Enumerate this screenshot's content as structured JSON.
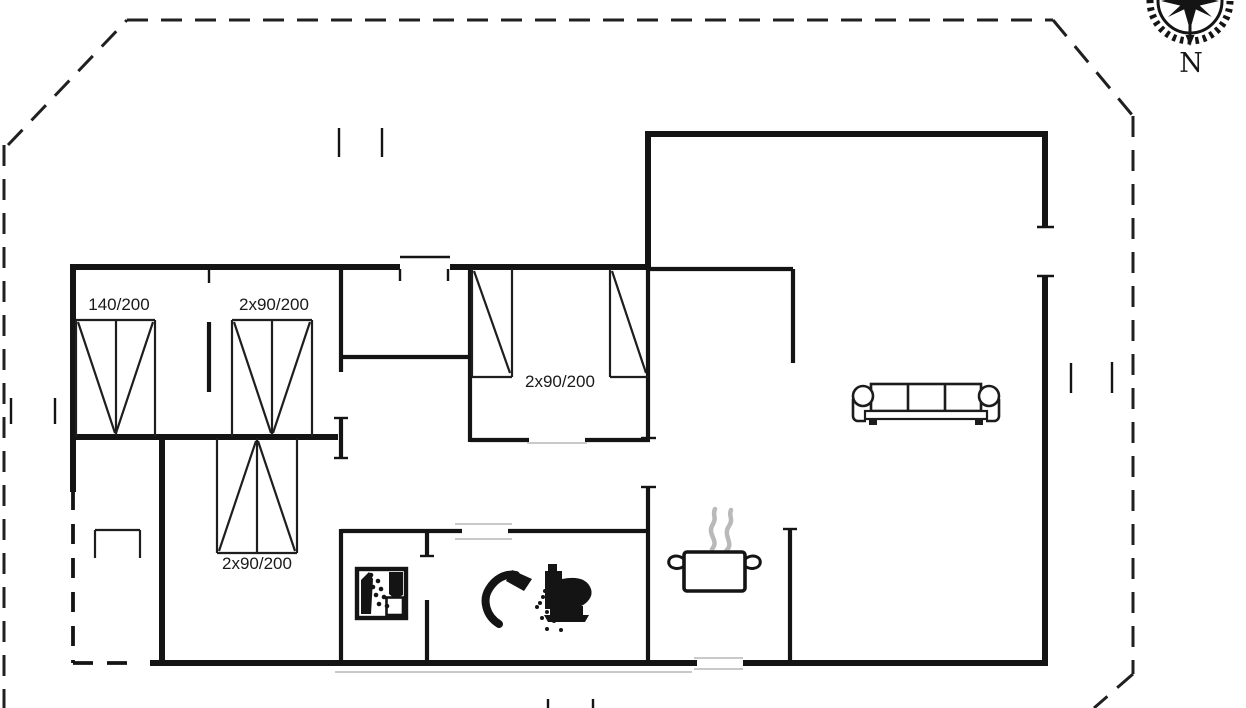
{
  "compass": {
    "label": "N"
  },
  "labels": [
    {
      "id": "bed-double-140",
      "text": "140/200",
      "x": 79,
      "y": 296,
      "w": 80
    },
    {
      "id": "bed-twin-top",
      "text": "2x90/200",
      "x": 226,
      "y": 296,
      "w": 96
    },
    {
      "id": "bed-twin-middle",
      "text": "2x90/200",
      "x": 512,
      "y": 373,
      "w": 96
    },
    {
      "id": "bed-twin-bottom",
      "text": "2x90/200",
      "x": 208,
      "y": 555,
      "w": 98
    }
  ],
  "icons": [
    {
      "name": "compass-rose-icon"
    },
    {
      "name": "washing-machine-icon"
    },
    {
      "name": "shower-icon"
    },
    {
      "name": "toilet-icon"
    },
    {
      "name": "cooking-pot-icon"
    },
    {
      "name": "sofa-symbol"
    }
  ],
  "floorplan": {
    "background": "#ffffff",
    "ink": "#141414",
    "faint": "#c9c9c9",
    "steam": "#b9b9b9",
    "layers": [
      {
        "cls": "wall-thick",
        "width": 6,
        "color": "#141414",
        "dash": null,
        "segs": [
          [
            70,
            267,
            400,
            267
          ],
          [
            450,
            267,
            651,
            267
          ],
          [
            648,
            131,
            648,
            269
          ],
          [
            645,
            134,
            1048,
            134
          ],
          [
            1045,
            131,
            1045,
            227
          ],
          [
            1045,
            276,
            1045,
            666
          ],
          [
            743,
            663,
            1048,
            663
          ],
          [
            150,
            663,
            697,
            663
          ],
          [
            73,
            264,
            73,
            492
          ],
          [
            71,
            437,
            338,
            437
          ],
          [
            162,
            435,
            162,
            665
          ]
        ]
      },
      {
        "cls": "wall-medium",
        "width": 4.2,
        "color": "#141414",
        "dash": null,
        "segs": [
          [
            648,
            269,
            793,
            269
          ],
          [
            793,
            269,
            793,
            363
          ],
          [
            209,
            322,
            209,
            392
          ],
          [
            341,
            267,
            341,
            372
          ],
          [
            341,
            357,
            470,
            357
          ],
          [
            470,
            267,
            470,
            442
          ],
          [
            341,
            418,
            341,
            458
          ],
          [
            470,
            440,
            529,
            440
          ],
          [
            585,
            440,
            650,
            440
          ],
          [
            648,
            269,
            648,
            438
          ],
          [
            648,
            487,
            648,
            665
          ],
          [
            341,
            531,
            462,
            531
          ],
          [
            508,
            531,
            650,
            531
          ],
          [
            341,
            529,
            341,
            665
          ],
          [
            427,
            531,
            427,
            556
          ],
          [
            427,
            600,
            427,
            665
          ],
          [
            790,
            529,
            790,
            665
          ]
        ]
      },
      {
        "cls": "tick-thin",
        "width": 2.4,
        "color": "#141414",
        "dash": null,
        "segs": [
          [
            209,
            270,
            209,
            283
          ],
          [
            400,
            269,
            400,
            281
          ],
          [
            448,
            269,
            448,
            281
          ],
          [
            339,
            128,
            339,
            157
          ],
          [
            382,
            128,
            382,
            157
          ],
          [
            11,
            398,
            11,
            424
          ],
          [
            55,
            398,
            55,
            424
          ],
          [
            1071,
            363,
            1071,
            393
          ],
          [
            1112,
            362,
            1112,
            393
          ],
          [
            548,
            699,
            548,
            708
          ],
          [
            593,
            699,
            593,
            708
          ],
          [
            1037,
            227,
            1054,
            227
          ],
          [
            1037,
            276,
            1054,
            276
          ],
          [
            641,
            438,
            656,
            438
          ],
          [
            641,
            487,
            656,
            487
          ],
          [
            334,
            418,
            348,
            418
          ],
          [
            334,
            458,
            348,
            458
          ],
          [
            420,
            556,
            434,
            556
          ],
          [
            783,
            529,
            797,
            529
          ],
          [
            400,
            257,
            450,
            257
          ]
        ]
      },
      {
        "cls": "bed-line",
        "width": 2.2,
        "color": "#1e1e1e",
        "dash": null,
        "segs": [
          [
            76,
            320,
            155,
            320
          ],
          [
            76,
            320,
            76,
            437
          ],
          [
            155,
            320,
            155,
            437
          ],
          [
            116,
            320,
            116,
            435
          ],
          [
            78,
            322,
            115,
            433
          ],
          [
            153,
            322,
            116,
            433
          ],
          [
            232,
            320,
            312,
            320
          ],
          [
            232,
            320,
            232,
            437
          ],
          [
            312,
            320,
            312,
            437
          ],
          [
            272,
            320,
            272,
            435
          ],
          [
            234,
            322,
            271,
            433
          ],
          [
            310,
            322,
            273,
            433
          ],
          [
            472,
            269,
            472,
            377
          ],
          [
            512,
            269,
            512,
            377
          ],
          [
            472,
            377,
            512,
            377
          ],
          [
            474,
            271,
            510,
            373
          ],
          [
            610,
            269,
            610,
            377
          ],
          [
            610,
            377,
            648,
            377
          ],
          [
            612,
            271,
            646,
            373
          ],
          [
            217,
            438,
            217,
            553
          ],
          [
            297,
            438,
            297,
            553
          ],
          [
            217,
            553,
            297,
            553
          ],
          [
            257,
            438,
            257,
            553
          ],
          [
            219,
            551,
            256,
            441
          ],
          [
            295,
            551,
            258,
            441
          ],
          [
            95,
            530,
            95,
            558
          ],
          [
            95,
            530,
            140,
            530
          ],
          [
            140,
            530,
            140,
            558
          ]
        ]
      },
      {
        "cls": "faint-line",
        "width": 2,
        "color": "#c9c9c9",
        "dash": null,
        "segs": [
          [
            527,
            443,
            587,
            443
          ],
          [
            455,
            524,
            512,
            524
          ],
          [
            455,
            539,
            512,
            539
          ],
          [
            694,
            658,
            743,
            658
          ],
          [
            694,
            669,
            743,
            669
          ],
          [
            335,
            672,
            692,
            672
          ]
        ]
      },
      {
        "cls": "plot-dash",
        "width": 3,
        "color": "#202020",
        "dash": "21 13",
        "segs": [
          [
            8,
            145,
            127,
            20
          ],
          [
            127,
            20,
            1053,
            20
          ],
          [
            1053,
            20,
            1133,
            116
          ],
          [
            1133,
            116,
            1133,
            674
          ],
          [
            1133,
            674,
            1094,
            708
          ],
          [
            4,
            145,
            4,
            708
          ]
        ]
      },
      {
        "cls": "house-dash",
        "width": 3.8,
        "color": "#141414",
        "dash": "20 14",
        "segs": [
          [
            73,
            490,
            73,
            663
          ],
          [
            73,
            663,
            133,
            663
          ]
        ]
      }
    ]
  }
}
